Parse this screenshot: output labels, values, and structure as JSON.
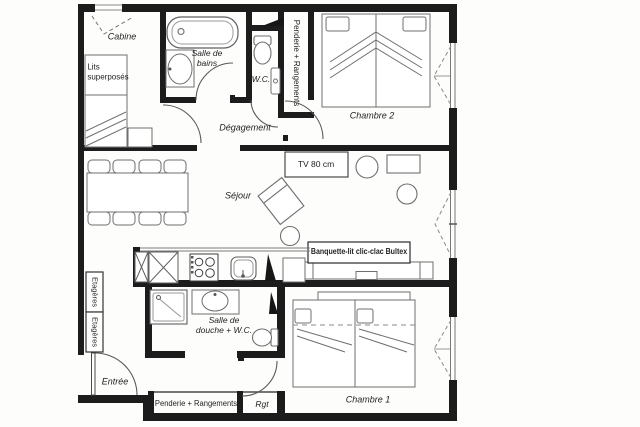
{
  "plan_title": "apartment-floor-plan",
  "colors": {
    "wall": "#1c1c1c",
    "fixture_line": "#6f6f6f",
    "label_text": "#1f1f1f",
    "background": "#fdfdfc"
  },
  "labels": {
    "cabine": "Cabine",
    "lits_superposes": "Lits\nsuperposés",
    "salle_de_bains": "Salle de\nbains",
    "wc": "W.C.",
    "penderie_haut": "Penderie + Rangements",
    "chambre_2": "Chambre 2",
    "degagement": "Dégagement",
    "sejour": "Séjour",
    "tv": "TV 80 cm",
    "banquette": "Banquette-lit clic-clac Bultex",
    "etageres_1": "Etagères",
    "etageres_2": "Etagères",
    "entree": "Entrée",
    "salle_de_douche": "Salle de\ndouche + W.C.",
    "penderie_bas": "Penderie + Rangements",
    "rgt": "Rgt",
    "chambre_1": "Chambre 1"
  }
}
